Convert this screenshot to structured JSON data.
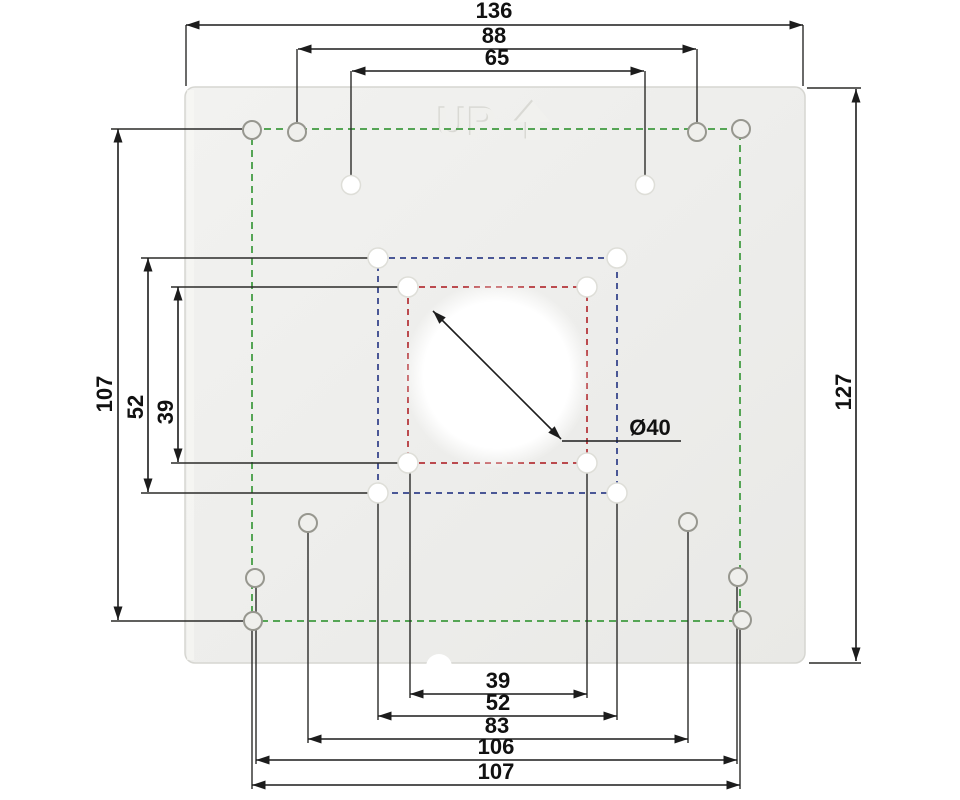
{
  "drawing": {
    "kind": "mounting-plate-dimension-drawing",
    "plate": {
      "embossed_text": "UP",
      "embossed_icon": "up-arrow",
      "fill_color": "#ececea"
    },
    "dimensions": {
      "top": [
        "136",
        "88",
        "65"
      ],
      "left": [
        "107",
        "52",
        "39"
      ],
      "right": [
        "127"
      ],
      "bottom": [
        "39",
        "52",
        "83",
        "106",
        "107"
      ],
      "center_diameter": "Ø40"
    },
    "pattern_colors": {
      "outer_green": "#55a555",
      "middle_blue": "#4a5796",
      "inner_red": "#bb4a4e",
      "dimension_lines": "#1c1c1c"
    }
  }
}
